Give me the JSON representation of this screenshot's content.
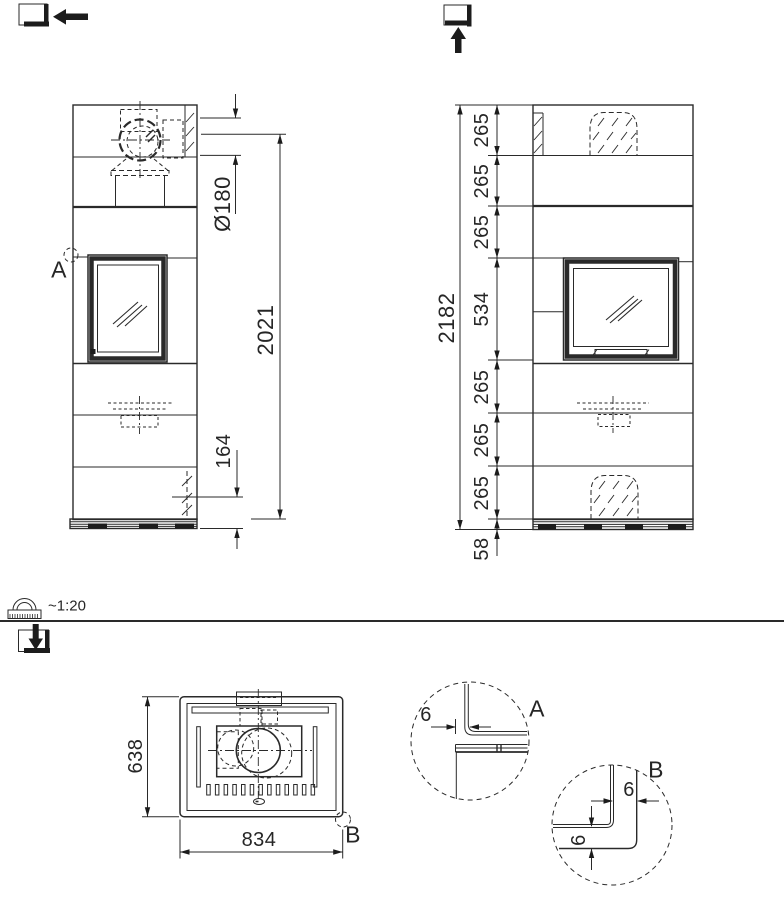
{
  "drawing": {
    "scale_label": "~1:20",
    "side_view": {
      "detail_marker": "A",
      "dim_flue_diameter": "Ø180",
      "dim_flue_height": "2021",
      "dim_base": "164"
    },
    "front_view": {
      "dim_total_height": "2182",
      "segments": [
        "265",
        "265",
        "265",
        "265",
        "265",
        "265"
      ],
      "dim_firebox": "534",
      "dim_plinth": "58"
    },
    "top_view": {
      "dim_depth": "638",
      "dim_width": "834",
      "detail_marker": "B"
    },
    "details": {
      "a": {
        "label": "A",
        "gap": "6"
      },
      "b": {
        "label": "B",
        "gap_h": "6",
        "gap_v": "6"
      }
    }
  }
}
